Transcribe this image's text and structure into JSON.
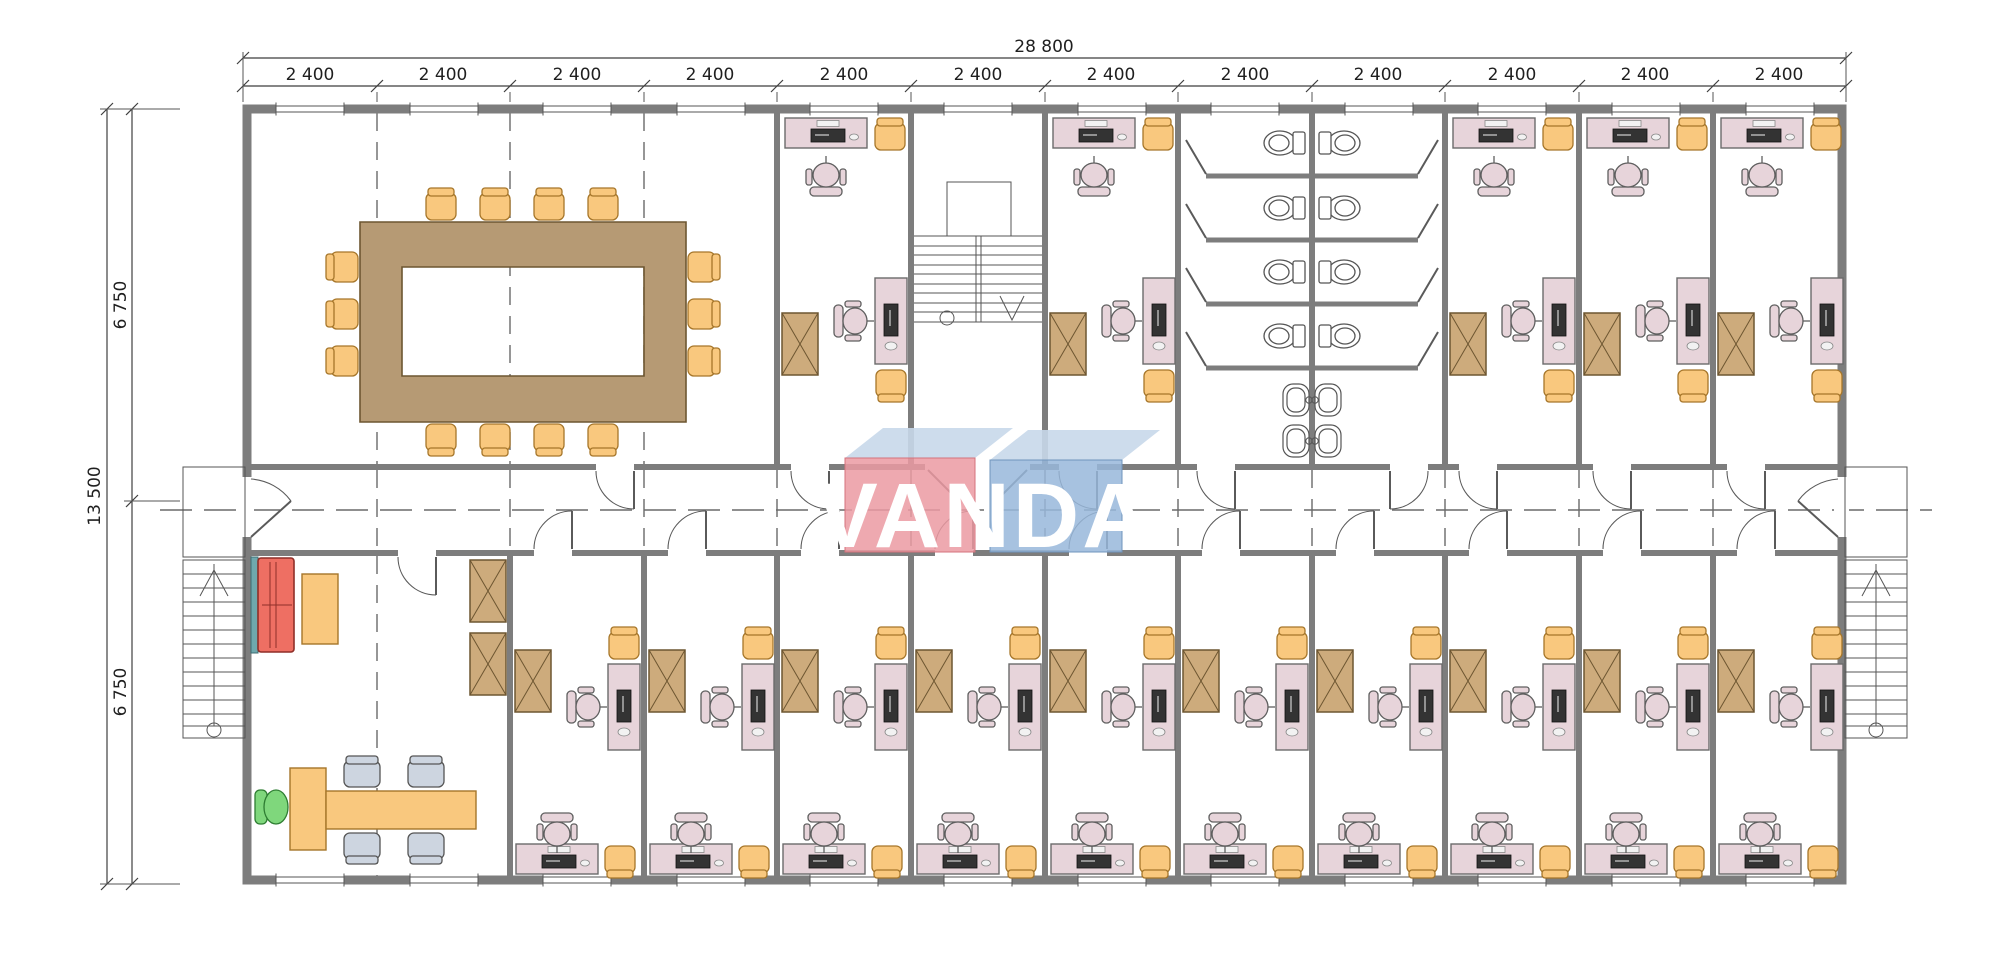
{
  "logo": {
    "text": "VANDA",
    "red_face": "#eb9aa2",
    "blue_face": "#98b7da",
    "top_face": "#c8d8ea",
    "text_color": "#ffffff"
  },
  "dimensions": {
    "total_width_label": "28 800",
    "module_width_label": "2 400",
    "module_count": 12,
    "total_depth_label": "13 500",
    "half_depth_label": "6 750"
  },
  "palette": {
    "wall": "#7d7d7d",
    "desk_pink": "#e7d4da",
    "chair_orange": "#f9c87e",
    "cabinet_tan": "#cdab7c",
    "meeting_table": "#b69a74",
    "sofa_red": "#ee6f63",
    "exec_chair_green": "#7fd77c",
    "guest_chair_gray": "#cdd5e0",
    "accent_teal": "#6fa8ad",
    "dimension_line": "#3f3f3f"
  },
  "plan": {
    "type": "floor-plan",
    "grid_modules_x": 12,
    "rooms_top": [
      "meeting-room",
      "office",
      "stairwell",
      "office",
      "toilets",
      "office",
      "office",
      "office"
    ],
    "rooms_bottom": [
      "executive-office",
      "office",
      "office",
      "office",
      "office",
      "office",
      "office",
      "office",
      "office",
      "office"
    ],
    "meeting_chairs": 14,
    "toilet_stalls": 8,
    "sinks": 4,
    "external_stairs": 2,
    "corridor": "central"
  }
}
